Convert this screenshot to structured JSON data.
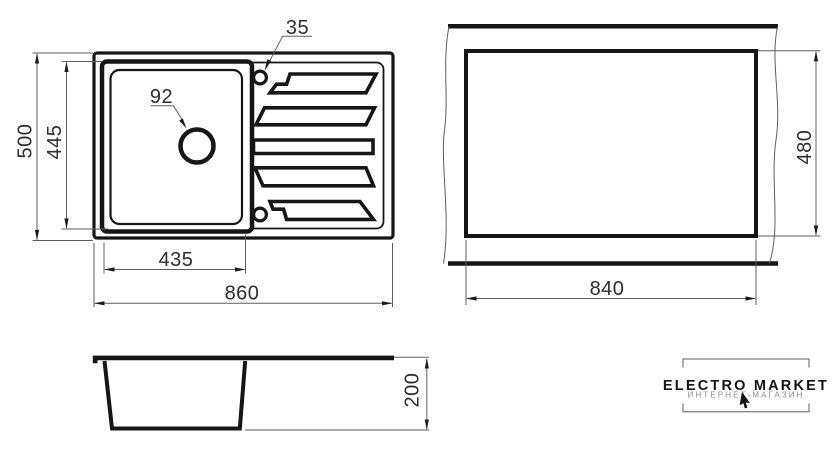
{
  "colors": {
    "line": "#161616",
    "thin_line": "#5f5f5f",
    "background": "#ffffff",
    "subtitle_gray": "#8f8f8f"
  },
  "top_view": {
    "dims": {
      "overall_width": "860",
      "overall_depth": "500",
      "bowl_width": "435",
      "bowl_depth": "445",
      "drain_hole_diameter": "92",
      "tap_hole_diameter": "35"
    }
  },
  "cutout_view": {
    "dims": {
      "width": "840",
      "height": "480"
    }
  },
  "side_view": {
    "dims": {
      "height": "200"
    }
  },
  "logo": {
    "title": "ELECTRO MARKET",
    "subtitle": "ИНТЕРНЕТ-МАГАЗИН"
  }
}
